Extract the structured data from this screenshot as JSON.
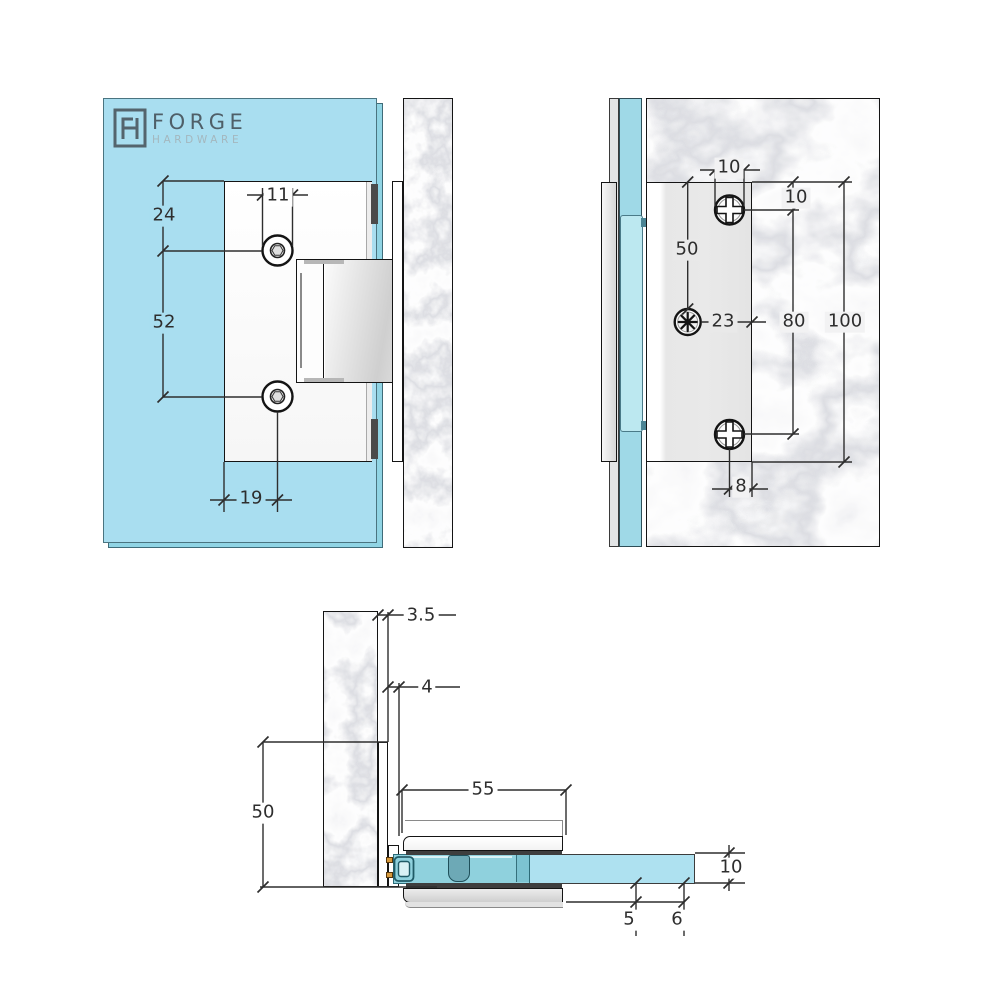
{
  "logo": {
    "brand": "FORGE",
    "sub": "HARDWARE"
  },
  "product": {
    "type": "glass-to-wall hinge technical drawing"
  },
  "colors": {
    "glass": "#a9def0",
    "glass_edge": "#90d4e4",
    "glass_inset": "#bce8f0",
    "marble_base": "#f4f4f6",
    "gasket": "#3e3e3e",
    "leaf_teal": "#8dd0db",
    "pivot": "#6da9b6",
    "pin_accent": "#d79a3d",
    "dim_line": "#2e2e2e"
  },
  "views": {
    "front": {
      "label": "front elevation",
      "dims": {
        "d24": "24",
        "d11": "11",
        "d52": "52",
        "d19": "19"
      }
    },
    "side": {
      "label": "side elevation on wall",
      "dims": {
        "d10_top": "10",
        "d10_offset": "10",
        "d50": "50",
        "d23": "23",
        "d80": "80",
        "d100": "100",
        "d8": "8"
      }
    },
    "plan": {
      "label": "plan section",
      "dims": {
        "d3_5": "3.5",
        "d4": "4",
        "d50": "50",
        "d55": "55",
        "d10": "10",
        "d5": "5",
        "d6": "6"
      }
    }
  }
}
